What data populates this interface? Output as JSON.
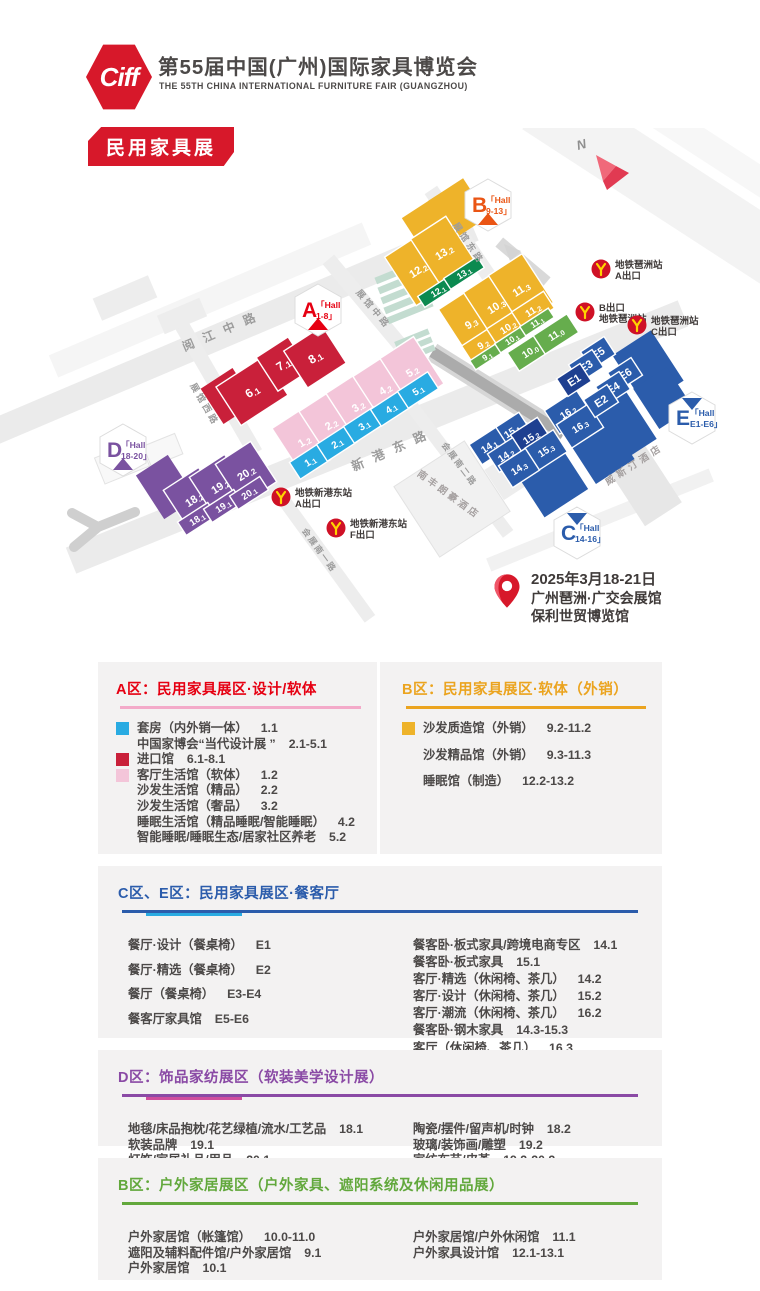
{
  "header": {
    "logo_text": "Ciff",
    "title": "第55届中国(广州)国际家具博览会",
    "subtitle": "THE 55TH CHINA INTERNATIONAL FURNITURE FAIR (GUANGZHOU)",
    "badge": "民用家具展"
  },
  "map": {
    "compass": "N",
    "colors": {
      "red": "#c9203a",
      "pink": "#f3c5d9",
      "blue": "#29abe2",
      "yellow": "#eeb32a",
      "green": "#66ad4d",
      "dgreen": "#0b8a50",
      "navy": "#2b5cab",
      "dnavy": "#1e3f90",
      "purple": "#7a52a0"
    },
    "hall_badges": [
      {
        "id": "A",
        "letter": "A",
        "line1": "「Hall",
        "line2": "1-8」",
        "color": "#e60012",
        "dir": "down"
      },
      {
        "id": "B",
        "letter": "B",
        "line1": "「Hall",
        "line2": "9-13」",
        "color": "#ea5514",
        "dir": "down"
      },
      {
        "id": "C",
        "letter": "C",
        "line1": "「Hall",
        "line2": "14-16」",
        "color": "#2b5cab",
        "dir": "up"
      },
      {
        "id": "D",
        "letter": "D",
        "line1": "「Hall",
        "line2": "18-20」",
        "color": "#7a52a0",
        "dir": "down"
      },
      {
        "id": "E",
        "letter": "E",
        "line1": "「Hall",
        "line2": "E1-E6」",
        "color": "#2b5cab",
        "dir": "up"
      }
    ],
    "blocks": [
      {
        "label": "18.2",
        "c": "purple"
      },
      {
        "label": "19.2",
        "c": "purple"
      },
      {
        "label": "20.2",
        "c": "purple"
      },
      {
        "label": "18.1",
        "c": "purple"
      },
      {
        "label": "19.1",
        "c": "purple"
      },
      {
        "label": "20.1",
        "c": "purple"
      },
      {
        "label": "6.1",
        "c": "red"
      },
      {
        "label": "7.1",
        "c": "red"
      },
      {
        "label": "8.1",
        "c": "red"
      },
      {
        "label": "1.2",
        "c": "pink"
      },
      {
        "label": "2.2",
        "c": "pink"
      },
      {
        "label": "3.2",
        "c": "pink"
      },
      {
        "label": "4.2",
        "c": "pink"
      },
      {
        "label": "5.2",
        "c": "pink"
      },
      {
        "label": "1.1",
        "c": "blue"
      },
      {
        "label": "2.1",
        "c": "blue"
      },
      {
        "label": "3.1",
        "c": "blue"
      },
      {
        "label": "4.1",
        "c": "blue"
      },
      {
        "label": "5.1",
        "c": "blue"
      },
      {
        "label": "12.2",
        "c": "yellow"
      },
      {
        "label": "13.2",
        "c": "yellow"
      },
      {
        "label": "12.1",
        "c": "dgreen"
      },
      {
        "label": "13.1",
        "c": "dgreen"
      },
      {
        "label": "9.3",
        "c": "yellow"
      },
      {
        "label": "10.3",
        "c": "yellow"
      },
      {
        "label": "11.3",
        "c": "yellow"
      },
      {
        "label": "9.2",
        "c": "yellow"
      },
      {
        "label": "10.2",
        "c": "yellow"
      },
      {
        "label": "11.2",
        "c": "yellow"
      },
      {
        "label": "9.1",
        "c": "green"
      },
      {
        "label": "10.1",
        "c": "green"
      },
      {
        "label": "11.1",
        "c": "green"
      },
      {
        "label": "10.0",
        "c": "green"
      },
      {
        "label": "11.0",
        "c": "green"
      },
      {
        "label": "16.2",
        "c": "navy"
      },
      {
        "label": "16.3",
        "c": "navy"
      },
      {
        "label": "15.1",
        "c": "navy"
      },
      {
        "label": "15.2",
        "c": "dnavy"
      },
      {
        "label": "15.3",
        "c": "navy"
      },
      {
        "label": "14.1",
        "c": "navy"
      },
      {
        "label": "14.2",
        "c": "navy"
      },
      {
        "label": "14.3",
        "c": "navy"
      },
      {
        "label": "E5",
        "c": "navy"
      },
      {
        "label": "E3",
        "c": "navy"
      },
      {
        "label": "E1",
        "c": "dnavy"
      },
      {
        "label": "E6",
        "c": "navy"
      },
      {
        "label": "E4",
        "c": "navy"
      },
      {
        "label": "E2",
        "c": "navy"
      }
    ],
    "metro_stations": [
      {
        "id": "pazhou-a",
        "line1": "地铁琶洲站",
        "line2": "A出口"
      },
      {
        "id": "pazhou-b",
        "line1": "B出口",
        "line2": "地铁琶洲站"
      },
      {
        "id": "pazhou-c",
        "line1": "地铁琶洲站",
        "line2": "C出口"
      },
      {
        "id": "xingangdong-a",
        "line1": "地铁新港东站",
        "line2": "A出口"
      },
      {
        "id": "xingangdong-f",
        "line1": "地铁新港东站",
        "line2": "F出口"
      }
    ],
    "streets": [
      "阅江中路",
      "展馆西路",
      "展馆中路",
      "展馆东路",
      "新港东路",
      "会展南一路",
      "会展南二路"
    ],
    "buildings": [
      "威斯汀酒店",
      "南丰朗豪酒店"
    ],
    "event": {
      "date": "2025年3月18-21日",
      "venue_line1": "广州琶洲·广交会展馆",
      "venue_line2": "保利世贸博览馆"
    }
  },
  "sections": [
    {
      "layout": "dual",
      "left": {
        "title": "A区：民用家具展区·设计/软体",
        "color": "#e60012",
        "rule": "#f3aac9",
        "items": [
          {
            "swatch": "#29abe2",
            "text": "套房（内外销一体）",
            "num": "1.1"
          },
          {
            "text": "中国家博会“当代设计展 ”",
            "num": "2.1-5.1"
          },
          {
            "swatch": "#c9203a",
            "text": "进口馆",
            "num": "6.1-8.1"
          },
          {
            "swatch": "#f3c5d9",
            "text": "客厅生活馆（软体）",
            "num": "1.2"
          },
          {
            "text": "沙发生活馆（精品）",
            "num": "2.2"
          },
          {
            "text": "沙发生活馆（奢品）",
            "num": "3.2"
          },
          {
            "text": "睡眠生活馆（精品睡眠/智能睡眠）",
            "num": "4.2"
          },
          {
            "text": "智能睡眠/睡眠生态/居家社区养老",
            "num": "5.2"
          }
        ]
      },
      "right": {
        "title": "B区：民用家具展区·软体（外销）",
        "color": "#eba41f",
        "rule": "#eba41f",
        "items": [
          {
            "swatch": "#eeb32a",
            "text": "沙发质造馆（外销）",
            "num": "9.2-11.2"
          },
          {
            "text": "沙发精品馆（外销）",
            "num": "9.3-11.3"
          },
          {
            "text": "睡眠馆（制造）",
            "num": "12.2-13.2"
          }
        ]
      }
    },
    {
      "layout": "single",
      "title": "C区、E区：民用家具展区·餐客厅",
      "color": "#2b5cab",
      "rule": "#2b5cab",
      "rule_accent": "#29abe2",
      "left": [
        {
          "text": "餐厅·设计（餐桌椅）",
          "num": "E1"
        },
        {
          "text": "餐厅·精选（餐桌椅）",
          "num": "E2"
        },
        {
          "text": "餐厅（餐桌椅）",
          "num": "E3-E4"
        },
        {
          "text": "餐客厅家具馆",
          "num": "E5-E6"
        }
      ],
      "right": [
        {
          "text": "餐客卧·板式家具/跨境电商专区",
          "num": "14.1"
        },
        {
          "text": "餐客卧·板式家具",
          "num": "15.1"
        },
        {
          "text": "客厅·精选（休闲椅、茶几）",
          "num": "14.2"
        },
        {
          "text": "客厅·设计（休闲椅、茶几）",
          "num": "15.2"
        },
        {
          "text": "客厅·潮流（休闲椅、茶几）",
          "num": "16.2"
        },
        {
          "text": "餐客卧·钢木家具",
          "num": "14.3-15.3"
        },
        {
          "text": "客厅（休闲椅、茶几）",
          "num": "16.3"
        }
      ]
    },
    {
      "layout": "single",
      "title": "D区：饰品家纺展区（软装美学设计展）",
      "color": "#8a4aa5",
      "rule": "#8a4aa5",
      "rule_accent": "#cf4e9e",
      "left": [
        {
          "text": "地毯/床品抱枕/花艺绿植/流水/工艺品",
          "num": "18.1"
        },
        {
          "text": "软装品牌",
          "num": "19.1"
        },
        {
          "text": "灯饰/家居礼品/用品",
          "num": "20.1"
        }
      ],
      "right": [
        {
          "text": "陶瓷/摆件/留声机/时钟",
          "num": "18.2"
        },
        {
          "text": "玻璃/装饰画/雕塑",
          "num": "19.2"
        },
        {
          "text": "家纺布艺/皮革",
          "num": "19.2-20.2"
        }
      ]
    },
    {
      "layout": "single",
      "title": "B区：户外家居展区（户外家具、遮阳系统及休闲用品展）",
      "color": "#62a83c",
      "rule": "#62a83c",
      "left": [
        {
          "text": "户外家居馆（帐篷馆）",
          "num": "10.0-11.0"
        },
        {
          "text": "遮阳及辅料配件馆/户外家居馆",
          "num": "9.1"
        },
        {
          "text": "户外家居馆",
          "num": "10.1"
        }
      ],
      "right": [
        {
          "text": "户外家居馆/户外休闲馆",
          "num": "11.1"
        },
        {
          "text": "户外家具设计馆",
          "num": "12.1-13.1"
        }
      ]
    }
  ]
}
